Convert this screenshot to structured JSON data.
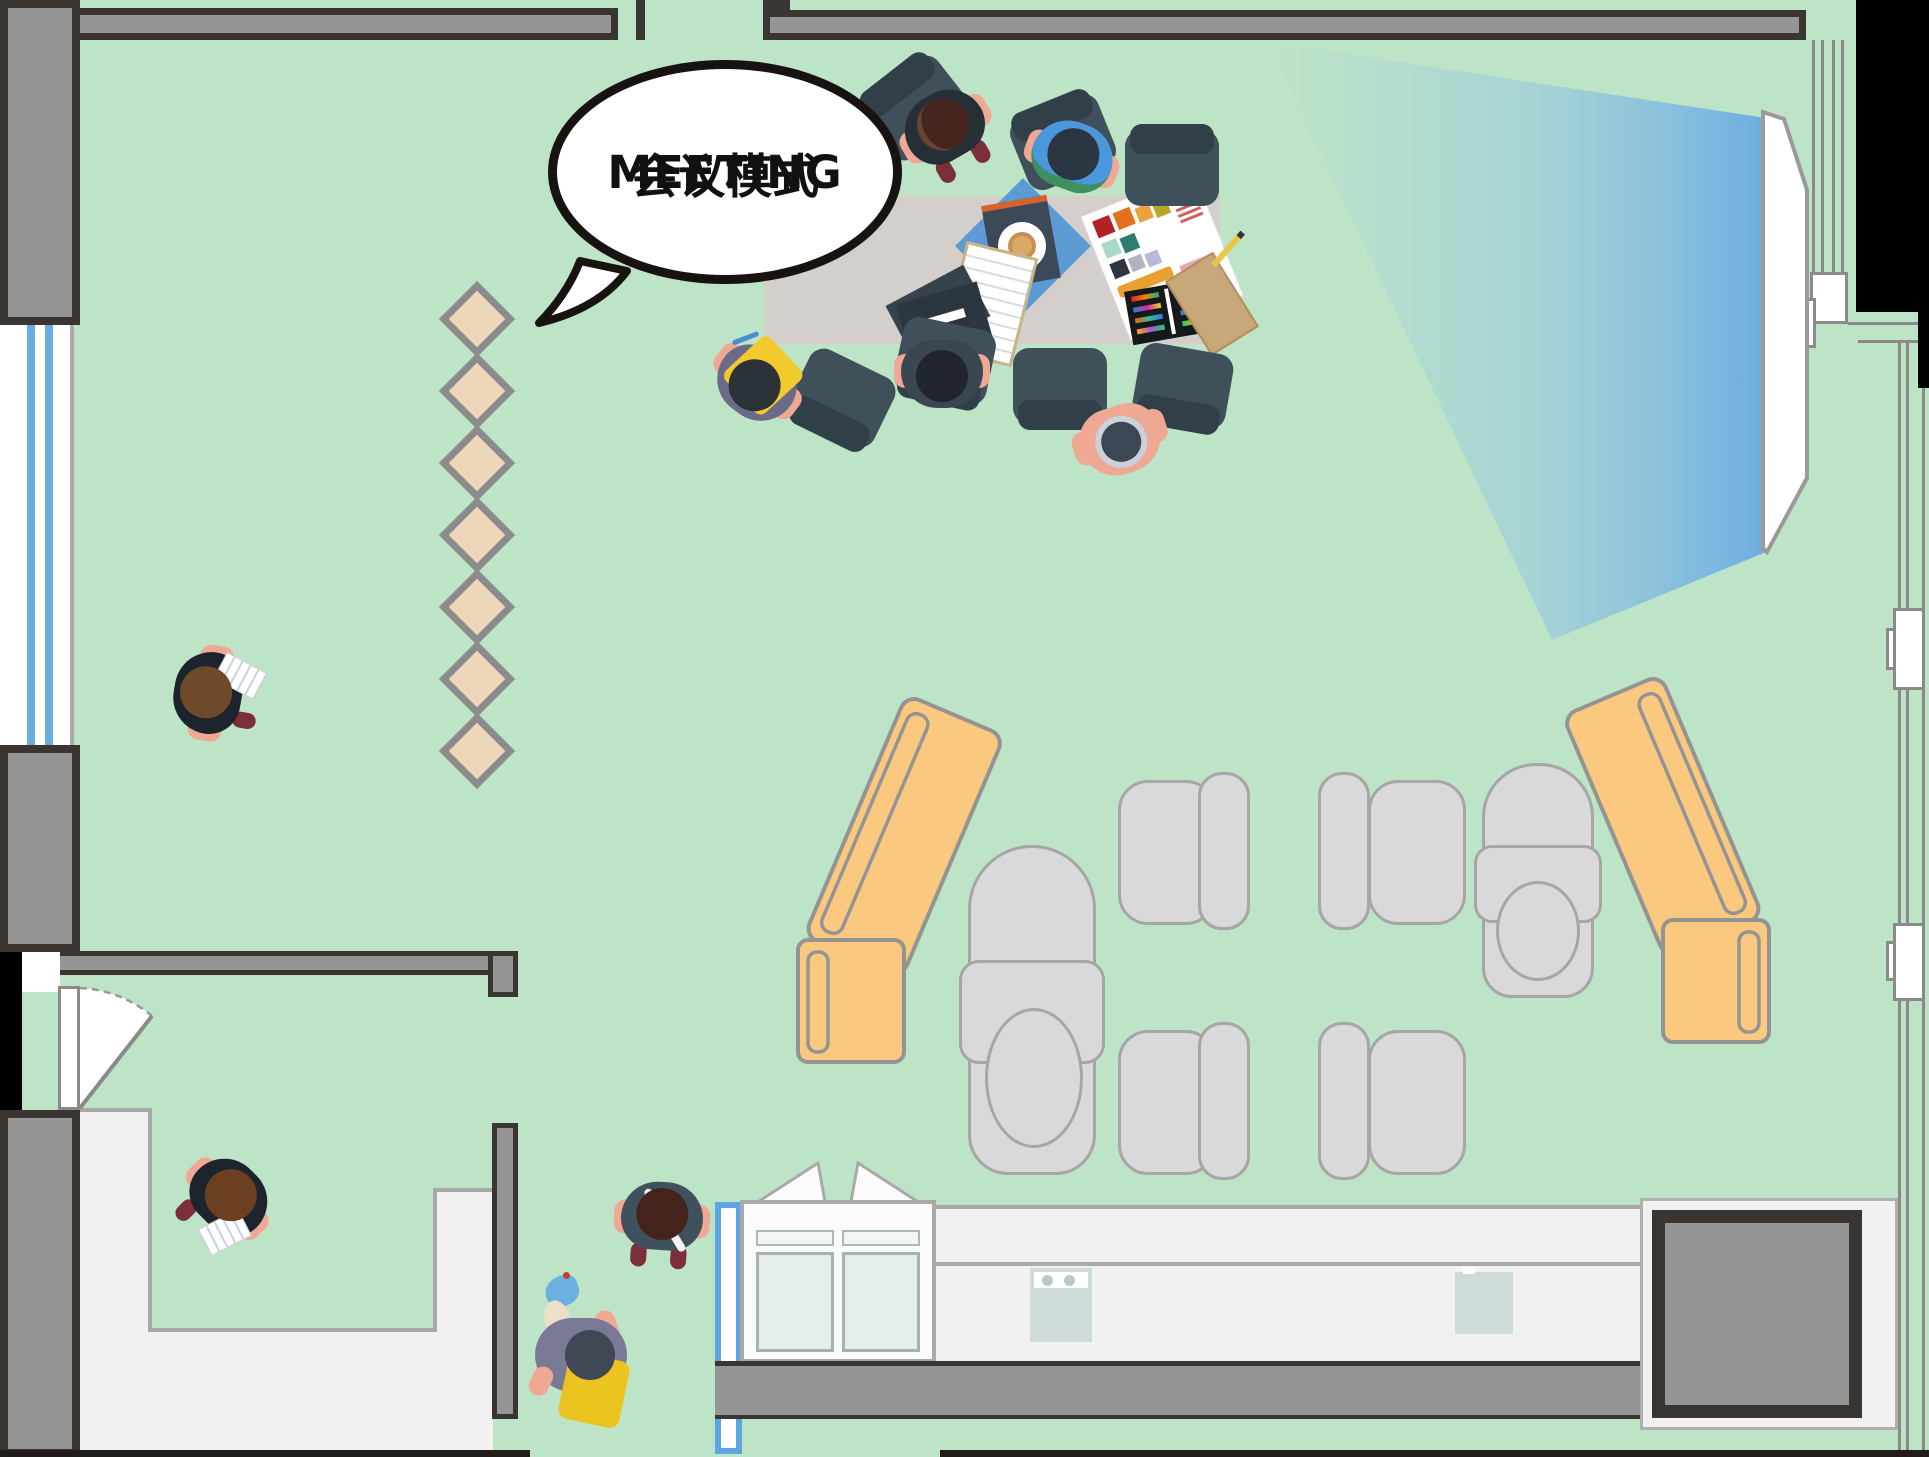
{
  "title": "Office floor plan — meeting mode (top-down illustration)",
  "speech_bubble": {
    "line1": "MEETING",
    "line2": "会议模式"
  },
  "theme": {
    "colors": {
      "floor": "#bee4c7",
      "wall-dark": "#3a3531",
      "wall-gray": "#959595",
      "floor-light": "#f1f1f1",
      "line-gray": "#a9a9a9",
      "table": "#d4cfca",
      "chair": "#3f505b",
      "chair-dark": "#313f49",
      "seat-gray": "#d9d9d9",
      "seat-border": "#a6a6a6",
      "sofa": "#fac87e",
      "sofa-border": "#949494",
      "tile": "#eed6bb",
      "tile-border": "#8b8b8b",
      "window-blue": "#68abdf",
      "door-blue": "#5aa5e2",
      "skin": "#efa893",
      "bubble-border": "#181310"
    }
  },
  "zones": {
    "meeting_area": "conference table with 8 chairs, documents and colour-swatch sheets",
    "lounge_area": "two bent orange sofas, two grey lounge chairs, four grey armchairs",
    "walkway": "seven tan diamond floor tiles",
    "projection": "wall screen with blue light beam",
    "kitchen": "counter with stove, appliance, open cabinet, blue sliding-door frame",
    "lower_left_room": "small room with swing door and light-grey floor border"
  },
  "people": [
    {
      "id": "p1",
      "location": "table top side",
      "top_color": "dark jacket",
      "hair": "dark brown"
    },
    {
      "id": "p2",
      "location": "table top side",
      "top_color": "blue shirt",
      "hair": "dark slate"
    },
    {
      "id": "p3",
      "location": "table bottom side",
      "top_color": "lavender grey",
      "hair": "slate with silver ring"
    },
    {
      "id": "p4",
      "location": "table bottom side",
      "top_color": "dark slate",
      "hair": "black"
    },
    {
      "id": "p5",
      "location": "table left end",
      "top_color": "slate purple",
      "hair": "dark",
      "accessory": "yellow bag, blue pen"
    },
    {
      "id": "p6",
      "location": "left mid room",
      "top_color": "black",
      "hair": "brown",
      "accessory": "white paper"
    },
    {
      "id": "p7",
      "location": "lower-left room",
      "top_color": "black",
      "hair": "brown",
      "accessory": "white paper"
    },
    {
      "id": "p8",
      "location": "bottom centre",
      "top_color": "dark teal",
      "hair": "dark brown bun",
      "accessory": "white strap"
    },
    {
      "id": "p9",
      "location": "bottom centre",
      "top_color": "grey purple",
      "hair": "dark slate",
      "accessory": "yellow bag, blue watering can"
    }
  ],
  "furniture_counts": {
    "dark_chairs": 8,
    "gray_armchairs": 4,
    "lounge_chairs": 2,
    "orange_sofas": 2,
    "diamond_tiles": 7
  }
}
